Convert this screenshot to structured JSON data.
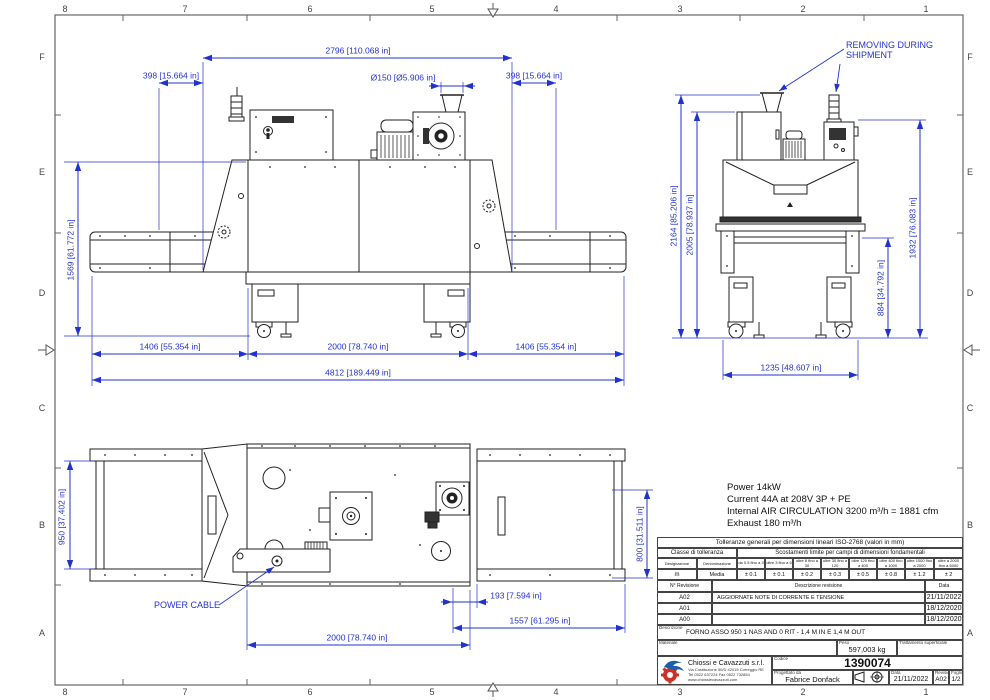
{
  "frame": {
    "columns": [
      "8",
      "7",
      "6",
      "5",
      "4",
      "3",
      "2",
      "1"
    ],
    "rows": [
      "F",
      "E",
      "D",
      "C",
      "B",
      "A"
    ]
  },
  "colors": {
    "dimension_blue": "#2233cc",
    "line_black": "#222222",
    "logo_blue": "#1c5fa8",
    "logo_red": "#c8342a"
  },
  "annotations": {
    "removing_line1": "REMOVING DURING",
    "removing_line2": "SHIPMENT",
    "power_cable": "POWER CABLE"
  },
  "notes": {
    "lines": [
      "Power 14kW",
      "Current 44A at 208V 3P + PE",
      "Internal AIR CIRCULATION 3200 m³/h = 1881 cfm",
      "Exhaust 180 m³/h"
    ]
  },
  "dims": {
    "front": {
      "total": "2796 [110.068 in]",
      "left_overhang": "398 [15.664 in]",
      "right_overhang": "398 [15.664 in]",
      "duct": "Ø150 [Ø5.906 in]",
      "height": "1569 [61.772 in]",
      "infeed": "1406 [55.354 in]",
      "oven": "2000 [78.740 in]",
      "outfeed": "1406 [55.354 in]",
      "overall": "4812 [189.449 in]"
    },
    "side": {
      "height_total": "2164 [85.206 in]",
      "height_cabinet": "2005 [78.937 in]",
      "height_panel": "1932 [76.083 in]",
      "belt_height": "884 [34.792 in]",
      "width": "1235 [48.607 in]"
    },
    "top": {
      "belt_in_width": "950 [37.402 in]",
      "belt_out_width": "800 [31.511 in]",
      "cable_offset": "193 [7.594 in]",
      "outfeed_len": "1557 [61.295 in]",
      "oven_len": "2000 [78.740 in]"
    }
  },
  "tolerance_table": {
    "title": "Tolleranze generali per dimensioni lineari ISO-2768 (valori in mm)",
    "class_header": "Classe di tolleranza",
    "ranges_header": "Scostamenti limite per campi di dimensioni fondamentali",
    "designazione_label": "Designazione",
    "denominazione_label": "Denominazione",
    "ranges": [
      "da 0.5 fino a 3",
      "oltre 3 fino a 6",
      "oltre 6 fino a 30",
      "oltre 30 fino a 120",
      "oltre 120 fino a 400",
      "oltre 400 fino a 1000",
      "oltre 1000 fino a 2000",
      "oltre a 2000 fino a 6000"
    ],
    "designation": "m",
    "denomination": "Media",
    "values": [
      "± 0.1",
      "± 0.1",
      "± 0.2",
      "± 0.3",
      "± 0.5",
      "± 0.8",
      "± 1.2",
      "± 2"
    ]
  },
  "revision_table": {
    "col_rev": "N° Revisione",
    "col_desc": "Descrizione revisione",
    "col_date": "Data",
    "rows": [
      {
        "rev": "A02",
        "desc": "AGGIORNATE NOTE DI CORRENTE E TENSIONE",
        "date": "21/11/2022"
      },
      {
        "rev": "A01",
        "desc": "",
        "date": "18/12/2020"
      },
      {
        "rev": "A00",
        "desc": "",
        "date": "18/12/2020"
      }
    ]
  },
  "title_block": {
    "descrizione_label": "Descrizione",
    "descrizione": "FORNO ASSO 950 1 NAS AND 0 RIT - 1,4 M IN E 1,4 M OUT",
    "materiale_label": "Materiale",
    "peso_label": "Peso",
    "peso": "597,003 kg",
    "trattamento_label": "Trattamento superficiale",
    "company": "Chiossi e Cavazzuti s.r.l.",
    "address1": "Via Costituzione 50/D 42015 Correggio RE",
    "address2": "Tel 0522 637224 Fax 0522 732854",
    "address3": "www.chiossiecavazzuti.com",
    "codice_label": "Codice",
    "codice": "1390074",
    "progettato_label": "Progettato da",
    "progettato": "Fabrice Donfack",
    "data_label": "Data",
    "data": "21/11/2022",
    "revisione_label": "Revisione",
    "revisione": "A02",
    "foglio_label": "Foglio",
    "foglio": "1/2"
  }
}
